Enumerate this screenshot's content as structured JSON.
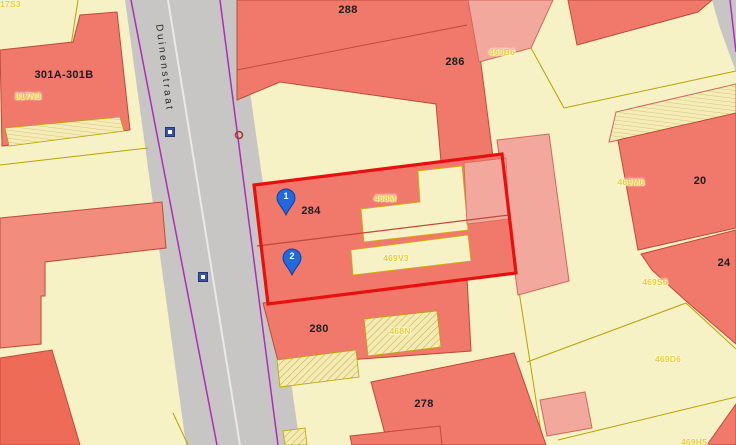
{
  "street_label": "Duinenstraat",
  "house_numbers": [
    {
      "text": "301A-301B"
    },
    {
      "text": "288"
    },
    {
      "text": "286"
    },
    {
      "text": "284"
    },
    {
      "text": "280"
    },
    {
      "text": "278"
    },
    {
      "text": "20"
    },
    {
      "text": "24"
    }
  ],
  "parcel_codes": [
    {
      "text": "317S3"
    },
    {
      "text": "317N3"
    },
    {
      "text": "469B6"
    },
    {
      "text": "468M"
    },
    {
      "text": "469V3"
    },
    {
      "text": "468N"
    },
    {
      "text": "469M6"
    },
    {
      "text": "469S6"
    },
    {
      "text": "469D6"
    },
    {
      "text": "469H5"
    }
  ],
  "markers": [
    {
      "number": "1"
    },
    {
      "number": "2"
    }
  ],
  "colors": {
    "building_red": "#F0796B",
    "building_bright_red": "#EE6B58",
    "building_light_pink": "#F2A89C",
    "parcel_cream": "#F7F1C6",
    "selection_outline": "#E90F0F",
    "road_gray": "#C8C6C4",
    "road_edge_purple": "#B02DB5",
    "parcel_line_olive": "#B8A400",
    "marker_blue": "#2268E0"
  }
}
